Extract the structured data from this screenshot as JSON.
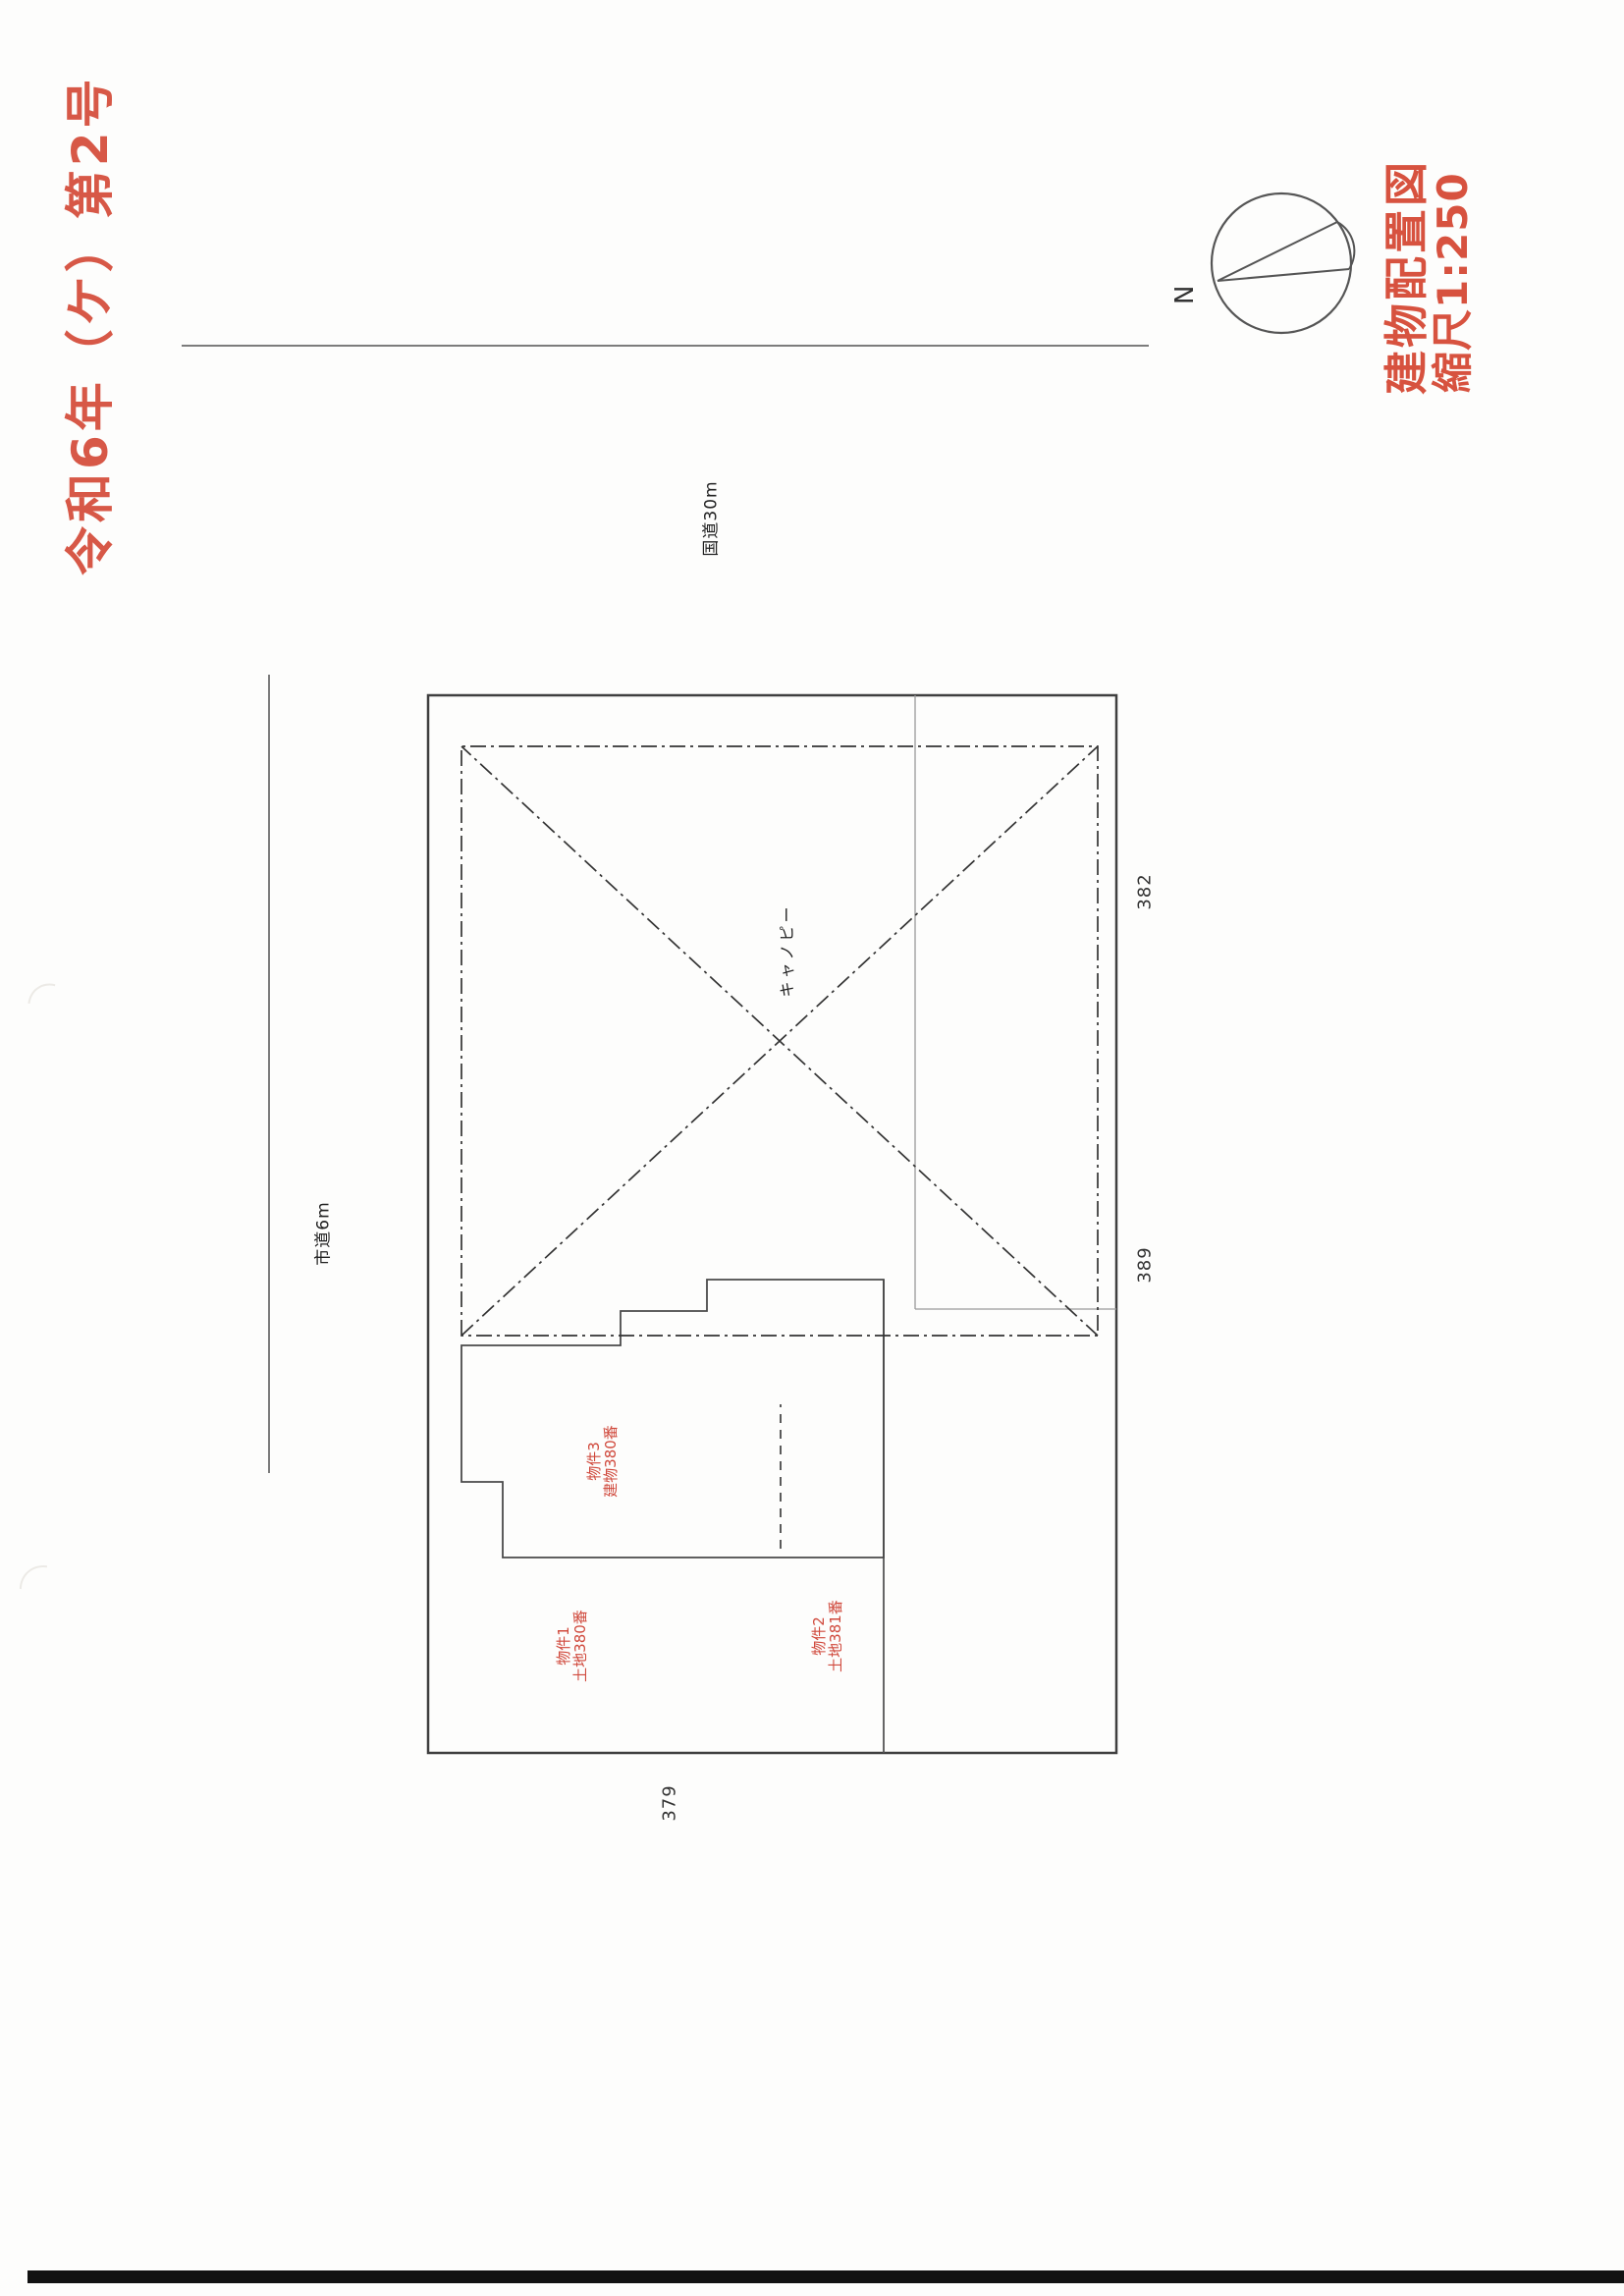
{
  "document": {
    "case_number": "令和6年（ケ）第2号",
    "title": "建物配置図",
    "scale": "縮尺1:250",
    "accent_color": "#d75847"
  },
  "compass": {
    "north_label": "N"
  },
  "site_plan": {
    "roads": {
      "national": "国道30m",
      "city": "市道6m"
    },
    "canopy_label": "キャノピー",
    "properties": [
      {
        "line1": "物件1",
        "line2": "土地380番"
      },
      {
        "line1": "物件2",
        "line2": "土地381番"
      },
      {
        "line1": "物件3",
        "line2": "建物380番"
      }
    ],
    "adjacent_parcels": [
      "379",
      "389",
      "382"
    ]
  }
}
